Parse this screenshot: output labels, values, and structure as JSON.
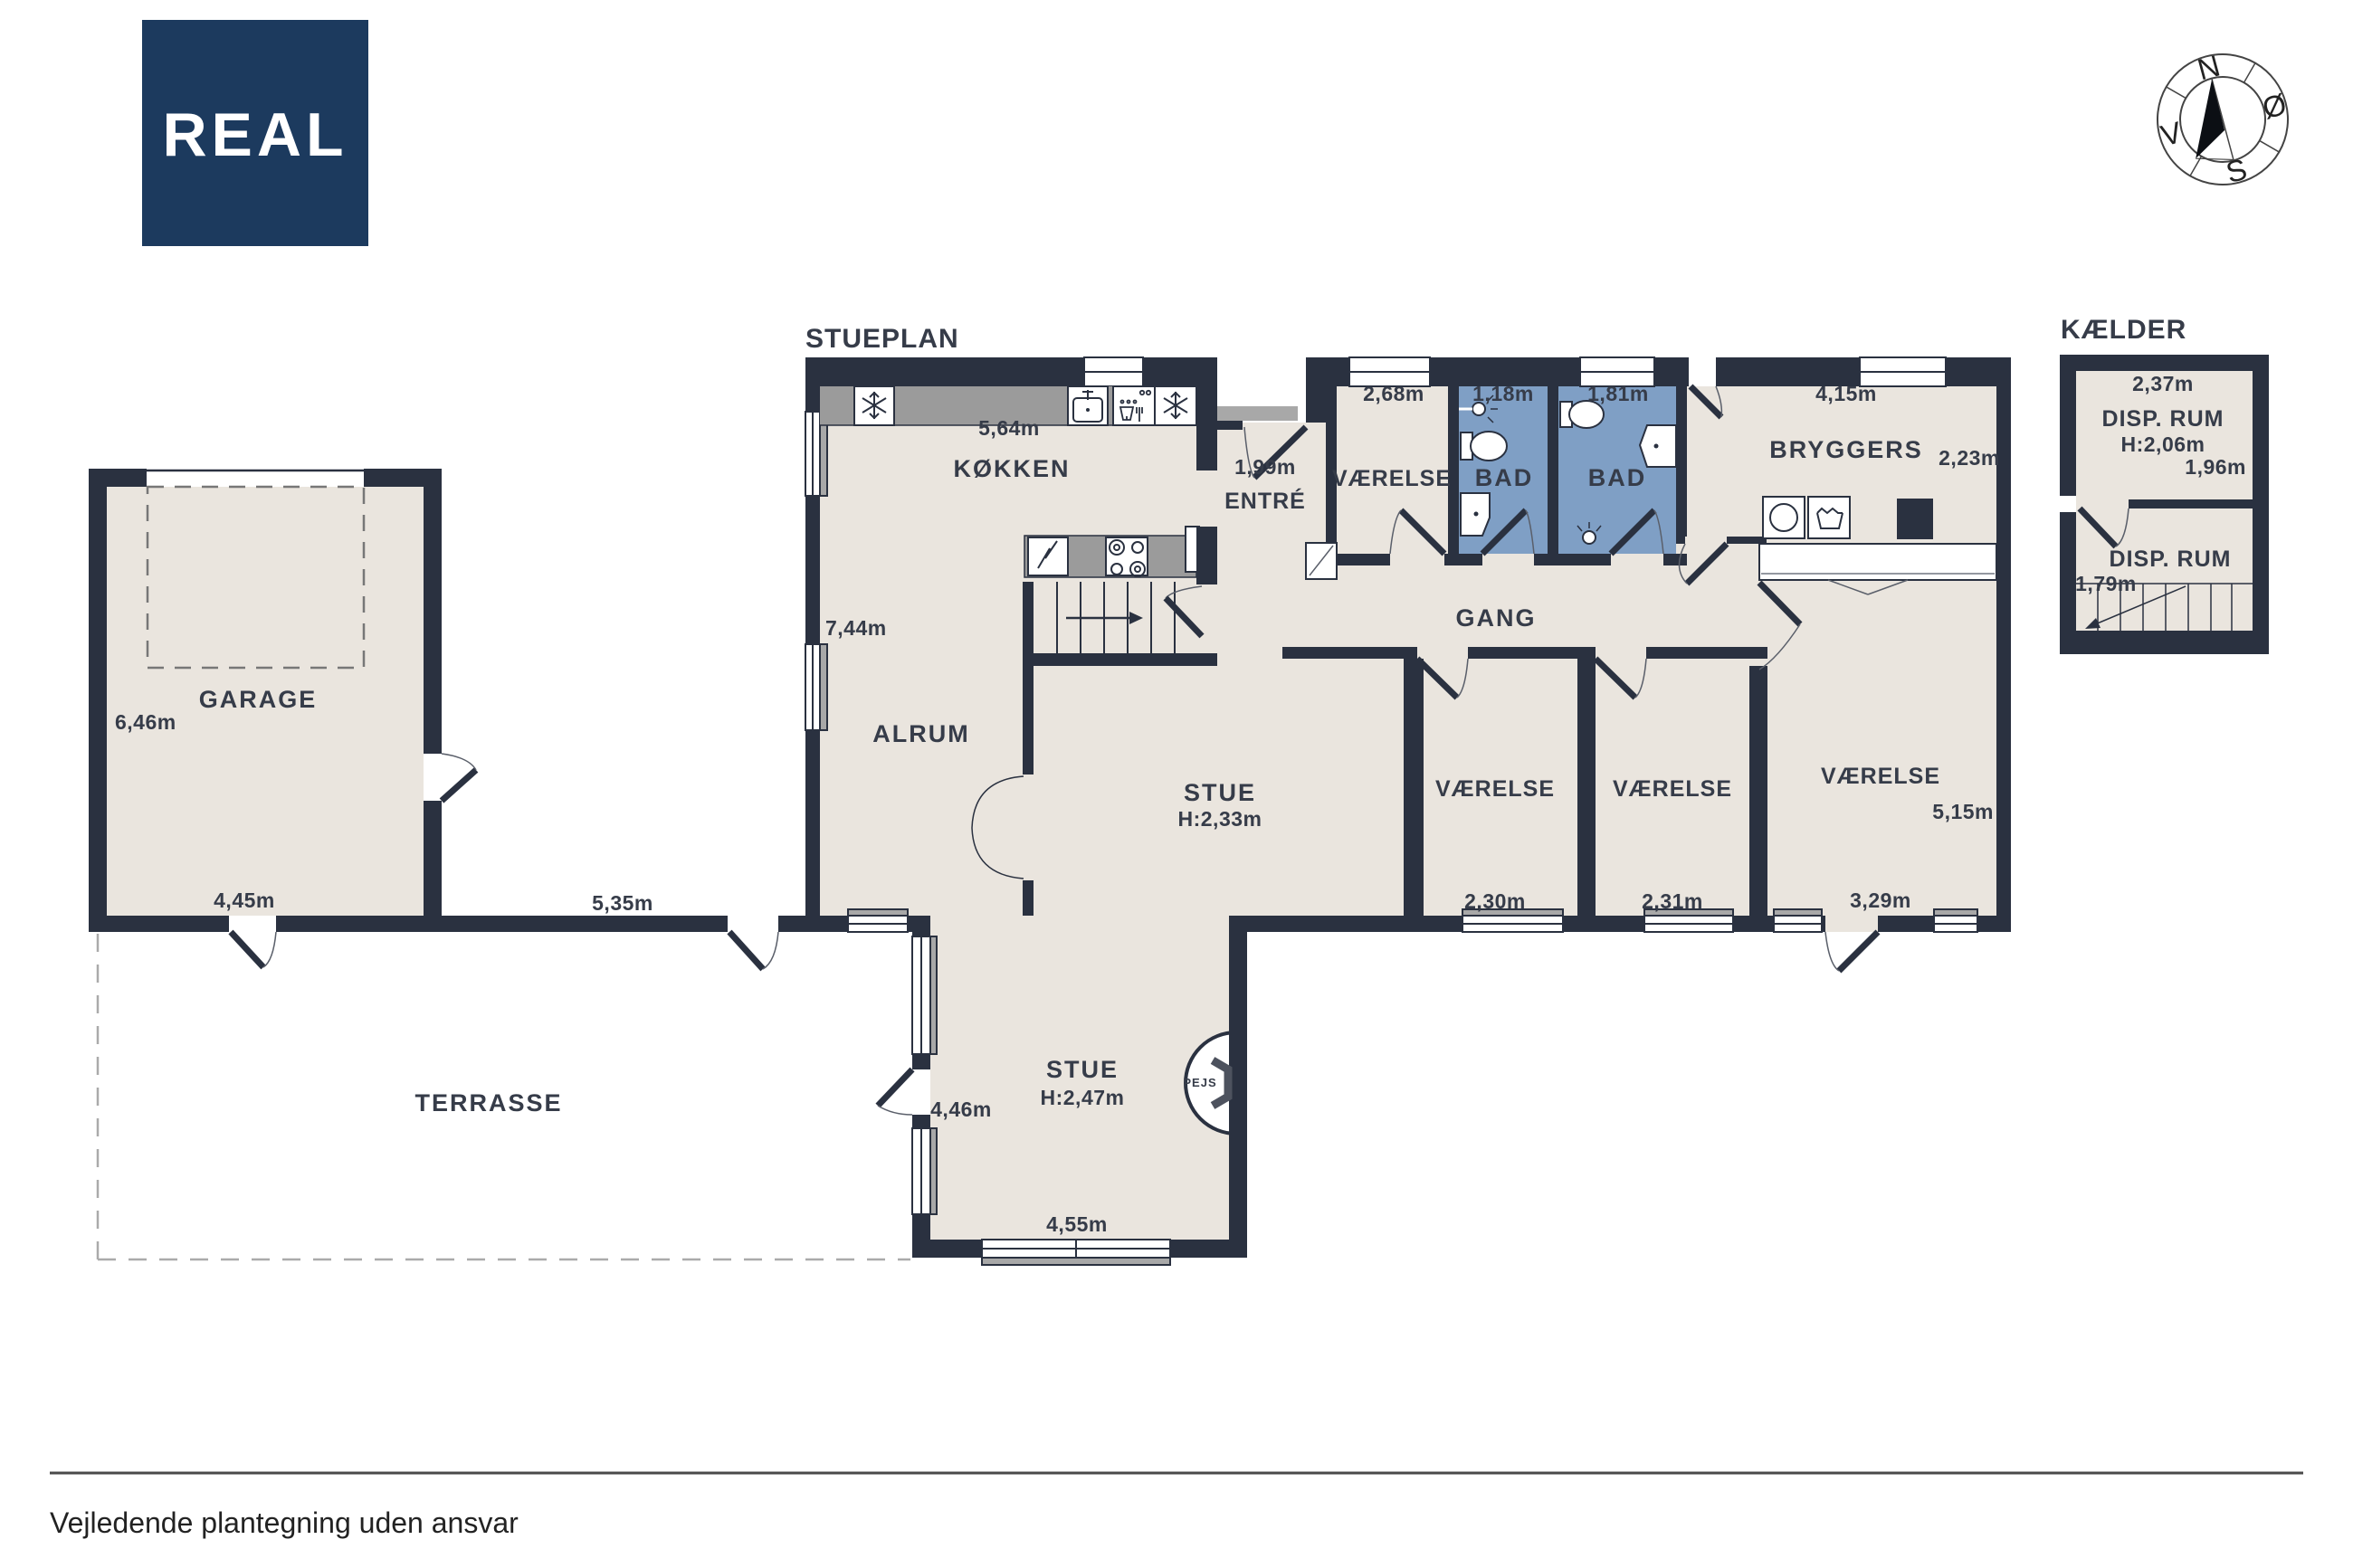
{
  "brand": {
    "logo_text": "REAL",
    "logo_bg": "#1c3a5e"
  },
  "plan_titles": {
    "main": "STUEPLAN",
    "basement": "KÆLDER"
  },
  "compass": {
    "north": "N",
    "east": "Ø",
    "south": "S",
    "west": "V"
  },
  "rooms": {
    "koekken": {
      "label": "KØKKEN",
      "width": "5,64m",
      "height": "7,44m"
    },
    "entre": {
      "label": "ENTRÉ",
      "door_width": "1,99m"
    },
    "vaerelse_nord": {
      "label": "VÆRELSE",
      "width": "2,68m"
    },
    "bad_1": {
      "label": "BAD",
      "width": "1,18m"
    },
    "bad_2": {
      "label": "BAD",
      "width": "1,81m"
    },
    "bryggers": {
      "label": "BRYGGERS",
      "width": "4,15m",
      "depth": "2,23m"
    },
    "gang": {
      "label": "GANG"
    },
    "alrum": {
      "label": "ALRUM"
    },
    "stue": {
      "label": "STUE",
      "ceiling_height": "H:2,33m"
    },
    "vaerelse_1": {
      "label": "VÆRELSE",
      "width": "2,30m"
    },
    "vaerelse_2": {
      "label": "VÆRELSE",
      "width": "2,31m"
    },
    "vaerelse_3": {
      "label": "VÆRELSE",
      "depth": "5,15m",
      "width": "3,29m"
    },
    "stue_syd": {
      "label": "STUE",
      "ceiling_height": "H:2,47m",
      "depth": "4,46m",
      "width": "4,55m"
    },
    "pejs": {
      "label": "PEJS"
    },
    "garage": {
      "label": "GARAGE",
      "depth": "6,46m",
      "width": "4,45m"
    },
    "terrasse": {
      "label": "TERRASSE"
    },
    "connector_width": "5,35m"
  },
  "basement": {
    "rum_1": {
      "label": "DISP. RUM",
      "width": "2,37m",
      "ceiling_height": "H:2,06m",
      "depth": "1,96m"
    },
    "rum_2": {
      "label": "DISP. RUM",
      "width": "1,79m"
    }
  },
  "footer": {
    "disclaimer": "Vejledende plantegning uden ansvar"
  },
  "colors": {
    "wall": "#2a3140",
    "floor": "#eae5de",
    "bath_floor": "#7f9fc5",
    "counter": "#9b9b9b",
    "logo_bg": "#1c3a5e",
    "text": "#363c49"
  }
}
